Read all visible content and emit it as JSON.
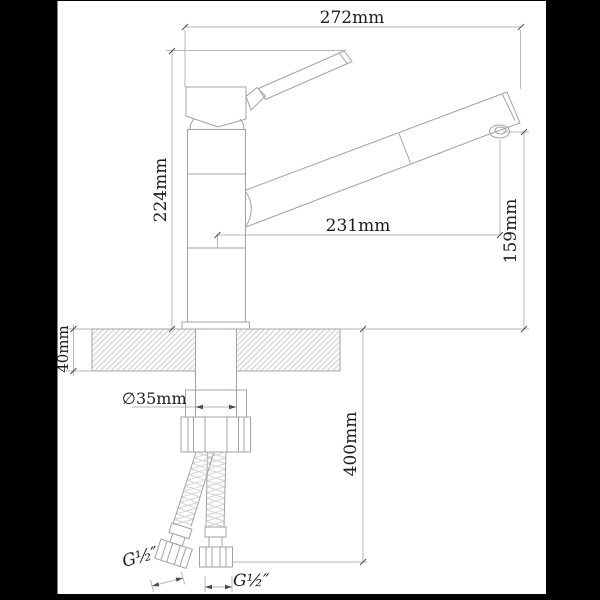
{
  "labels": {
    "dim_width_top": "272mm",
    "dim_height_left": "224mm",
    "dim_spout_reach": "231mm",
    "dim_spout_height": "159mm",
    "dim_counter_thickness": "40mm",
    "dim_hole_diameter": "∅35mm",
    "dim_hose_length": "400mm",
    "thread_left": "G½″",
    "thread_right": "G½″"
  },
  "colors": {
    "background": "#000000",
    "paper": "#ffffff",
    "drawing_lines": "#9fa3a6",
    "dimension_lines": "#b5b8ba",
    "text": "#1c1c1c"
  }
}
